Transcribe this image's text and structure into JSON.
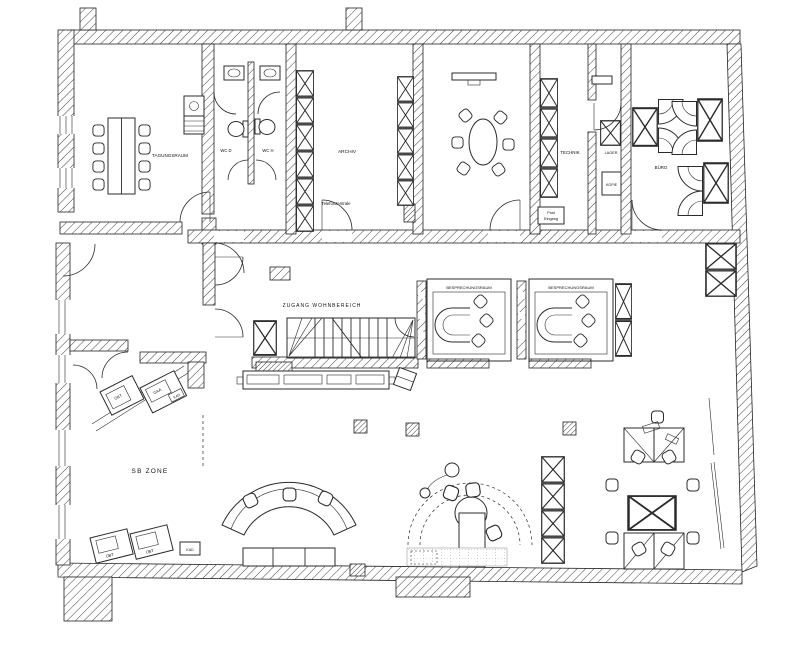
{
  "drawing": {
    "type": "bank-branch-floor-plan",
    "paper_color": "#ffffff",
    "ink_color": "#2b2b2b",
    "labels": {
      "meeting": "TAGUNGSRAUM",
      "wc_left": "WC D",
      "wc_right": "WC H",
      "archive": "ARCHIV",
      "phone": "Telefonzentrale",
      "technik": "TECHNIK",
      "post_line1": "Post",
      "post_line2": "Eingang",
      "lager": "LAGER",
      "kopie": "KOPIE",
      "office": "BÜRO",
      "consult_1": "BESPRECHUNGSRAUM",
      "consult_2": "BESPRECHUNGSRAUM",
      "stairs_access": "ZUGANG WOHNBEREICH",
      "sb_zone": "SB ZONE"
    },
    "devices": {
      "m1": "GKT",
      "m2": "GAA",
      "m3": "KAD",
      "m4": "ÜBT",
      "m5": "ÜBT",
      "m6": "KAD"
    }
  }
}
